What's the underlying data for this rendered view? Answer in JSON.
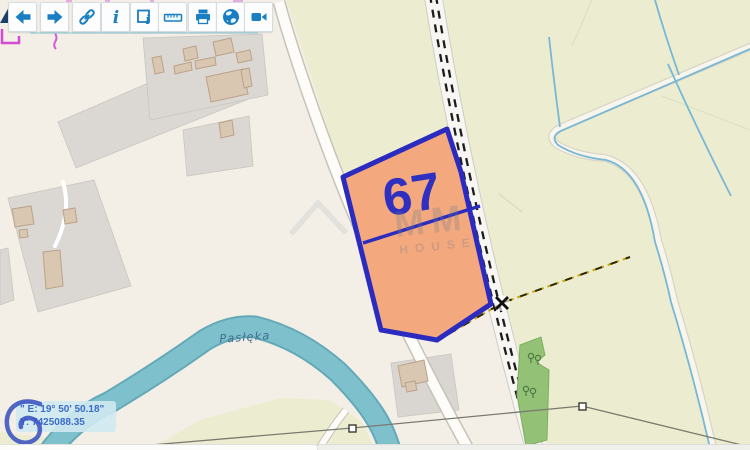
{
  "toolbar": {
    "buttons": [
      {
        "id": "back",
        "icon": "arrow-left-icon"
      },
      {
        "id": "forward",
        "icon": "arrow-right-icon"
      },
      {
        "id": "link",
        "icon": "link-icon"
      },
      {
        "id": "info",
        "icon": "info-icon"
      },
      {
        "id": "identify",
        "icon": "identify-icon"
      },
      {
        "id": "measure",
        "icon": "ruler-icon"
      },
      {
        "id": "print",
        "icon": "printer-icon"
      },
      {
        "id": "globe",
        "icon": "globe-icon"
      },
      {
        "id": "video",
        "icon": "camera-icon"
      }
    ]
  },
  "map": {
    "parcel_label": "67",
    "river_label": "Pasłęka",
    "watermark_line1": "MM",
    "watermark_line2": "HOUSE"
  },
  "status": {
    "coord_line1": "\" E: 19° 50' 50.18\"",
    "coord_line2": "Y: 7425088.35"
  },
  "colors": {
    "accent_blue": "#1a7ec2",
    "parcel_fill": "#f4a87e",
    "parcel_border": "#2b2bbf",
    "river": "#7fc0cd",
    "field_yellow": "#ecedd0",
    "base_cream": "#f3efe6",
    "magenta_line": "#d24bd2"
  }
}
